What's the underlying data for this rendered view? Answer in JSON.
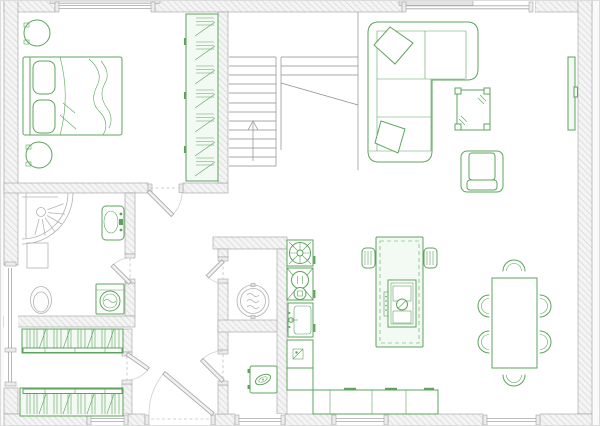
{
  "colors": {
    "background": "#fafafa",
    "floor": "#ffffff",
    "wall_fill": "#f4f4f4",
    "wall_hatch": "#d7d7d7",
    "wall_edge": "#9f9f9f",
    "green": "#5da35d",
    "green_fill": "#f3f9f3",
    "gray_fixture": "#b3b3b3",
    "stair": "#8e8e8e",
    "door": "#a6a6a6",
    "dash": "#c2c2c2",
    "frame": "#dcdcdc"
  },
  "plan": {
    "type": "floor-plan",
    "rooms": [
      {
        "name": "bedroom",
        "furniture": [
          "double-bed",
          "pillow",
          "pillow",
          "nightstand",
          "nightstand",
          "wardrobe"
        ]
      },
      {
        "name": "living-room",
        "furniture": [
          "corner-sofa",
          "cushion",
          "cushion",
          "coffee-table",
          "armchair",
          "tv"
        ]
      },
      {
        "name": "bathroom",
        "furniture": [
          "shower",
          "towel-radiator",
          "washbasin",
          "toilet",
          "washing-machine"
        ]
      },
      {
        "name": "kitchen",
        "furniture": [
          "counter",
          "extractor-fan",
          "oven",
          "kitchen-sink",
          "dishwasher",
          "island",
          "cooktop",
          "bar-stool",
          "bar-stool"
        ]
      },
      {
        "name": "dining-area",
        "furniture": [
          "dining-table",
          "chair",
          "chair",
          "chair",
          "chair",
          "chair",
          "chair"
        ]
      },
      {
        "name": "hallway",
        "furniture": []
      },
      {
        "name": "storage",
        "furniture": [
          "bookshelf",
          "bookshelf"
        ]
      },
      {
        "name": "utility",
        "furniture": [
          "water-heater",
          "boiler"
        ]
      },
      {
        "name": "staircase",
        "furniture": [
          "up-arrow"
        ]
      }
    ]
  }
}
